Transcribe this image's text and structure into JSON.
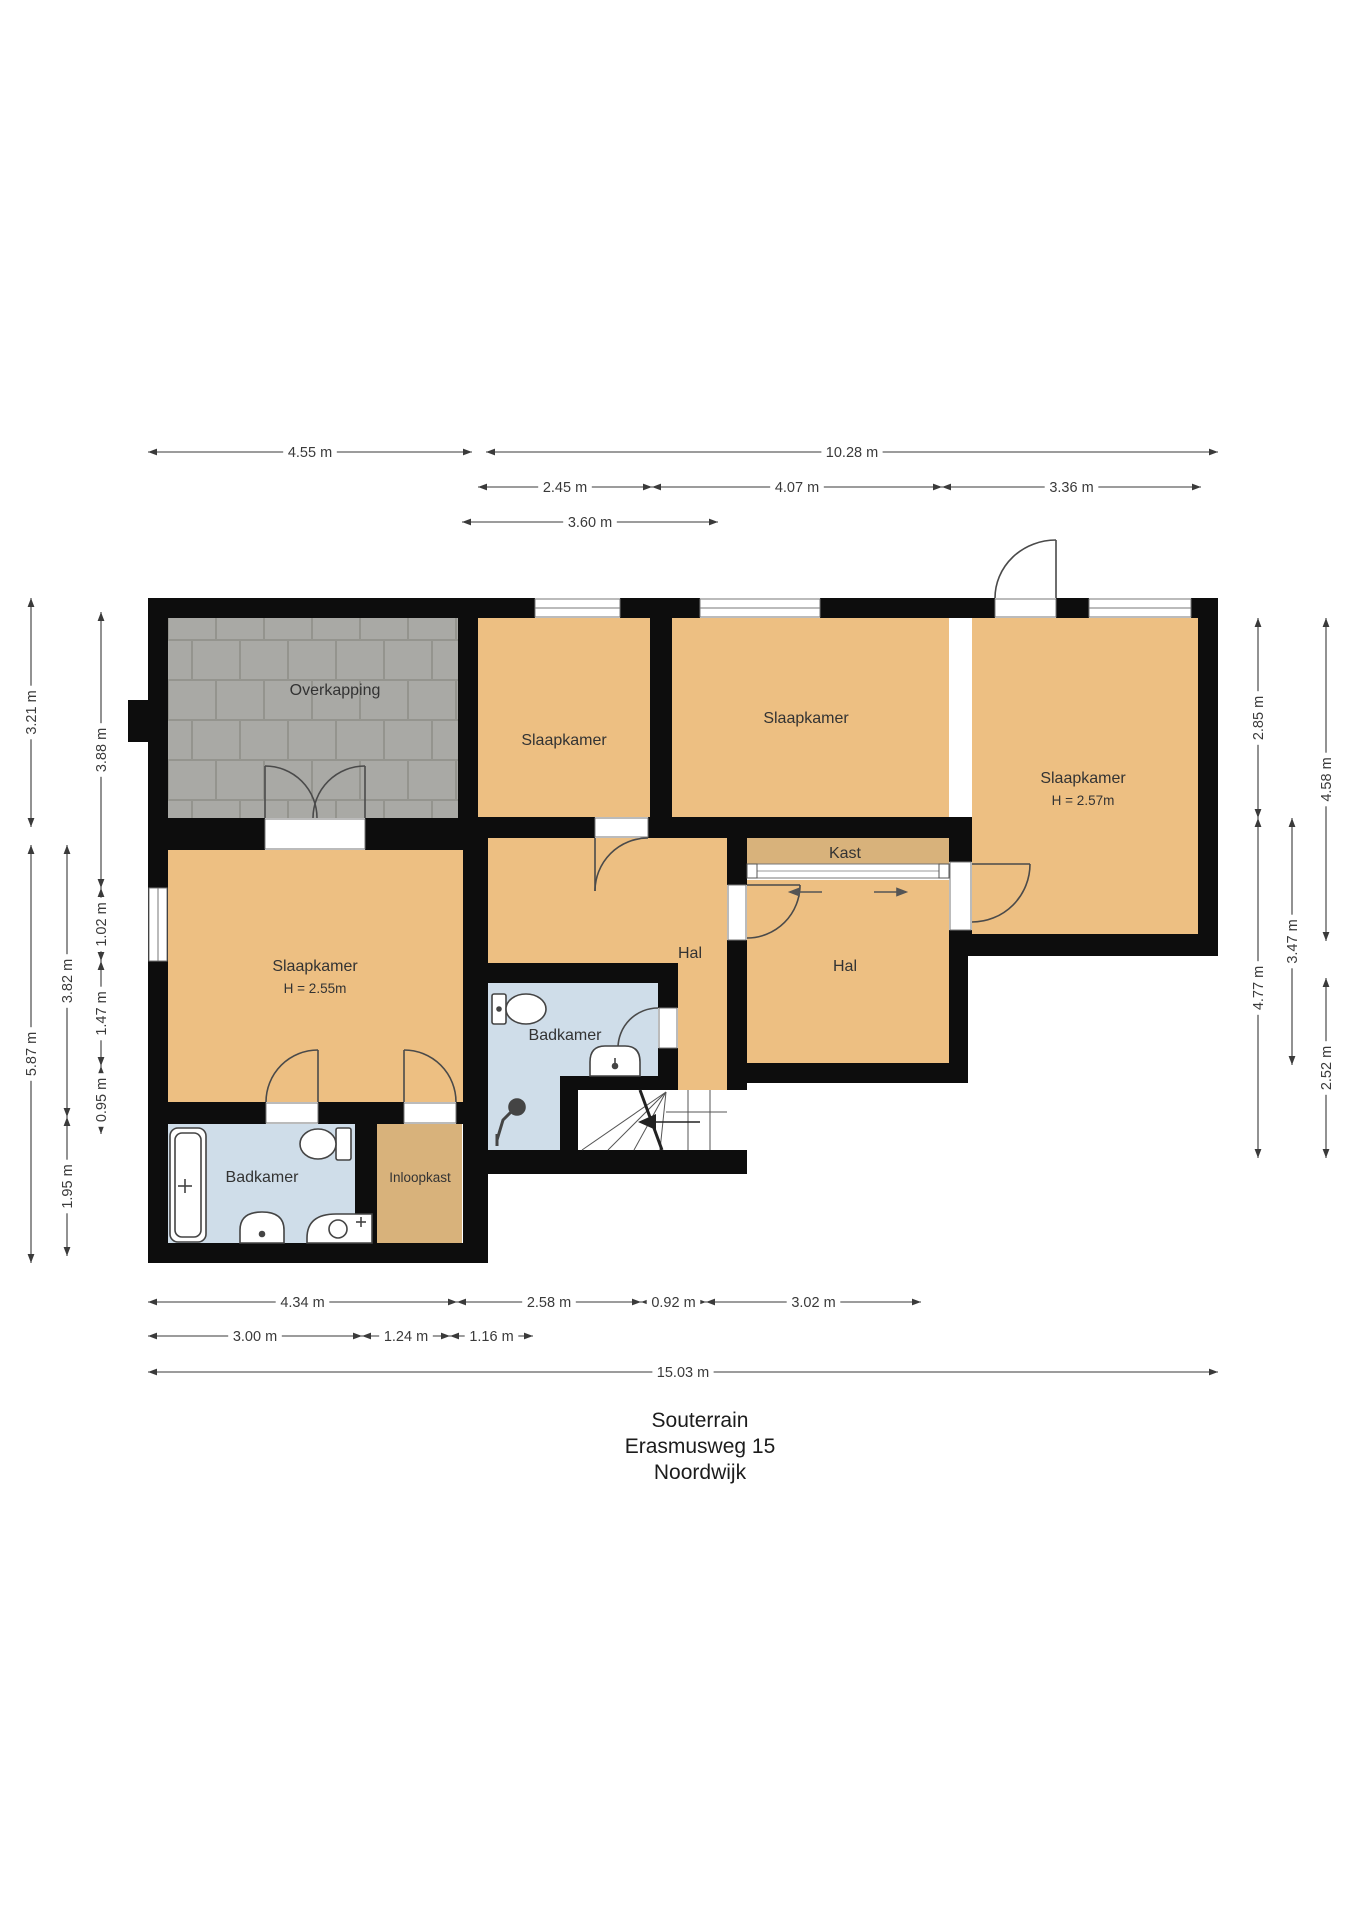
{
  "title_block": {
    "line1": "Souterrain",
    "line2": "Erasmusweg 15",
    "line3": "Noordwijk"
  },
  "rooms": {
    "overkapping": {
      "label": "Overkapping"
    },
    "slaapkamer_top_left": {
      "label": "Slaapkamer"
    },
    "slaapkamer_top_mid": {
      "label": "Slaapkamer"
    },
    "slaapkamer_right": {
      "label": "Slaapkamer",
      "height": "H = 2.57m"
    },
    "slaapkamer_left": {
      "label": "Slaapkamer",
      "height": "H = 2.55m"
    },
    "kast": {
      "label": "Kast"
    },
    "hal_mid": {
      "label": "Hal"
    },
    "hal_right": {
      "label": "Hal"
    },
    "badkamer_mid": {
      "label": "Badkamer"
    },
    "badkamer_left": {
      "label": "Badkamer"
    },
    "inloopkast": {
      "label": "Inloopkast"
    }
  },
  "dims": {
    "top": [
      "4.55 m",
      "10.28 m",
      "2.45 m",
      "4.07 m",
      "3.36 m",
      "3.60 m"
    ],
    "left": [
      "3.21 m",
      "5.87 m",
      "3.82 m",
      "1.95 m",
      "3.88 m",
      "1.02 m",
      "1.47 m",
      "0.95 m"
    ],
    "right": [
      "2.85 m",
      "4.77 m",
      "3.47 m",
      "4.58 m",
      "2.52 m"
    ],
    "bottom": [
      "4.34 m",
      "2.58 m",
      "0.92 m",
      "3.02 m",
      "3.00 m",
      "1.24 m",
      "1.16 m",
      "15.03 m"
    ]
  },
  "colors": {
    "room_fill": "#edbf82",
    "closet_fill": "#d8b27b",
    "bath_fill": "#cfdde9",
    "wall": "#0d0d0d",
    "paving": "#a9a9a5",
    "paving_joint": "#94948e",
    "dimension": "#3a3a3a",
    "label_text": "#333333",
    "title_text": "#1c1c1c",
    "door_stroke": "#4a4a4a",
    "fixture_stroke": "#444444"
  }
}
